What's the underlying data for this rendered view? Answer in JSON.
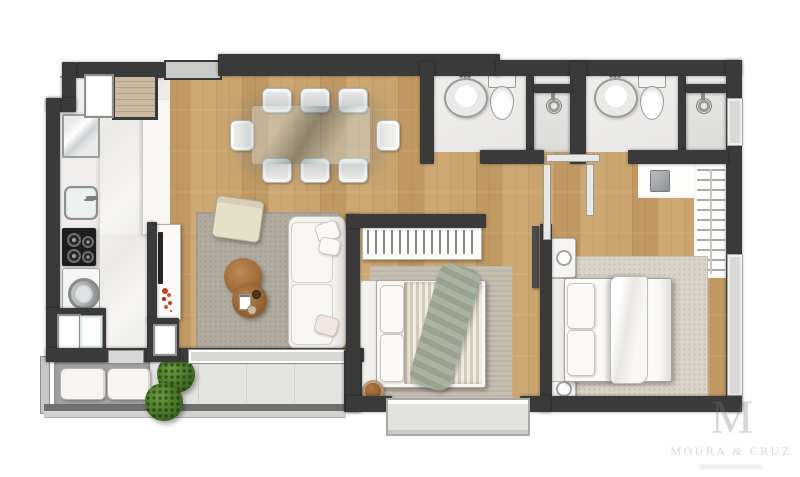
{
  "meta": {
    "kind": "apartment-floor-plan-top-view",
    "bedrooms": 2,
    "bathrooms": 2
  },
  "watermark": {
    "monogram": "M",
    "brand": "MOURA & CRUZ"
  },
  "palette": {
    "wall": "#3a3a3a",
    "wood_a": "#c9a46f",
    "wood_b": "#c09962",
    "marble": "#f3f2ef",
    "rug_living": "#b2aba0",
    "rug_bedroom1": "#c6bfb1",
    "rug_bedroom2": "#d9d3c8",
    "balcony_deck": "#a2a2a2",
    "balcony_tile": "#e3e4e2",
    "plant_green": "#4e7a2f",
    "flower_red": "#c2401d",
    "table_wood": "#b07840",
    "sofa_white": "#f4f2ee",
    "throw_green": "#aab3a0",
    "glass_table": "rgba(150,163,168,0.5)",
    "cooktop_black": "#1d1d1f"
  },
  "rooms": [
    {
      "name": "kitchen"
    },
    {
      "name": "living-dining-room"
    },
    {
      "name": "balcony"
    },
    {
      "name": "bathroom-1"
    },
    {
      "name": "bathroom-2"
    },
    {
      "name": "hallway"
    },
    {
      "name": "bedroom-1"
    },
    {
      "name": "bedroom-2"
    },
    {
      "name": "closet"
    }
  ],
  "furniture": [
    {
      "name": "refrigerator"
    },
    {
      "name": "kitchen-sink"
    },
    {
      "name": "cooktop"
    },
    {
      "name": "washing-machine"
    },
    {
      "name": "drawer-cabinet"
    },
    {
      "name": "utility-shaft"
    },
    {
      "name": "tv-sideboard"
    },
    {
      "name": "red-flowers"
    },
    {
      "name": "dining-table-glass"
    },
    {
      "name": "dining-chairs-x8"
    },
    {
      "name": "sofa"
    },
    {
      "name": "armchair"
    },
    {
      "name": "coffee-tables-round-x2"
    },
    {
      "name": "living-rug"
    },
    {
      "name": "balcony-bench-cushions"
    },
    {
      "name": "plants-x2"
    },
    {
      "name": "washbasin-x2"
    },
    {
      "name": "toilet-x2"
    },
    {
      "name": "shower-x2"
    },
    {
      "name": "wardrobe-hangers"
    },
    {
      "name": "closet-hangers"
    },
    {
      "name": "safe-box"
    },
    {
      "name": "double-bed-1-striped"
    },
    {
      "name": "green-throw-blanket"
    },
    {
      "name": "stool"
    },
    {
      "name": "double-bed-2-white"
    },
    {
      "name": "nightstand-x2"
    }
  ]
}
